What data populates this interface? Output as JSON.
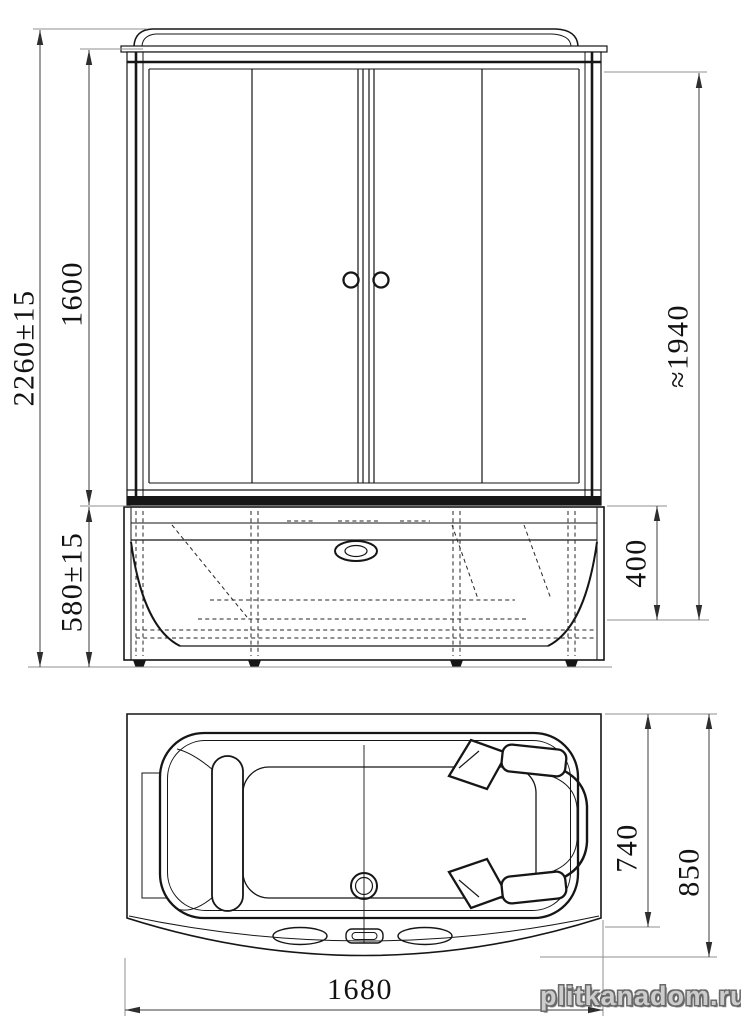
{
  "page": {
    "background": "#ffffff"
  },
  "views": {
    "front_view": {
      "name": "front-elevation-of-shower-cabin"
    },
    "plan_view": {
      "name": "top-plan-of-bathtub"
    }
  },
  "dimensions": {
    "overall_height": "2260±15",
    "cabin_glass_height": "1600",
    "tray_height": "580±15",
    "inner_clearance_height": "≈1940",
    "tray_rim_depth": "400",
    "plan_tub_depth": "740",
    "plan_overall_depth": "850",
    "plan_overall_width": "1680"
  },
  "watermark": {
    "text": "plitkanadom.ru"
  },
  "colors": {
    "line": "#161616",
    "dimension_line": "#3c3c3c",
    "extension_line": "#8f8f8f",
    "watermark_fill": "#cccccc",
    "watermark_outline": "#6a6a6a"
  }
}
